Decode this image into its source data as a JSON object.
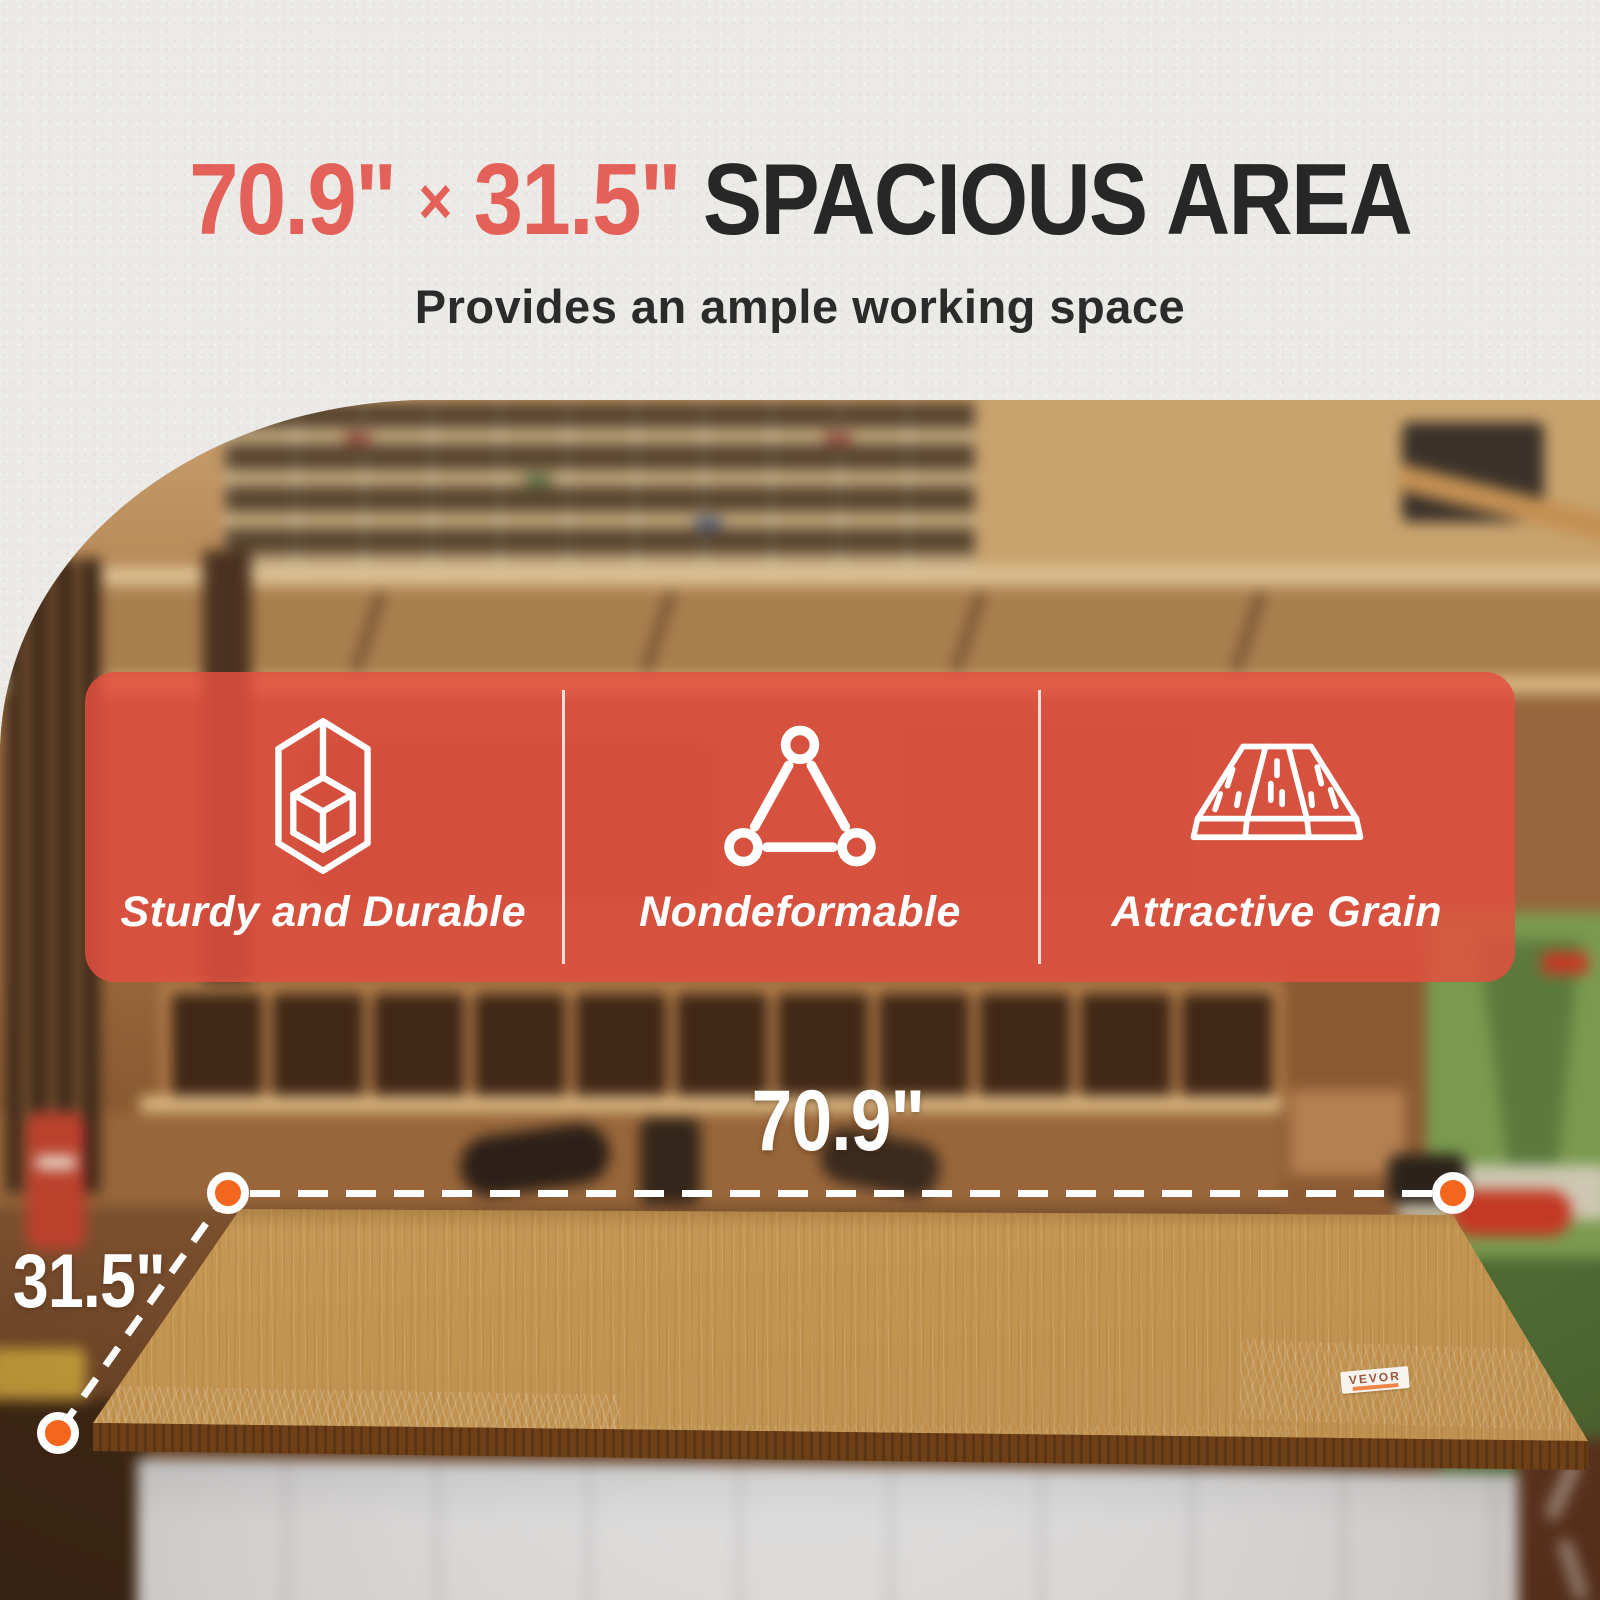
{
  "header": {
    "width_value": "70.9\"",
    "times_sign": "×",
    "depth_value": "31.5\"",
    "title_text": "SPACIOUS AREA",
    "subtitle": "Provides an ample working space"
  },
  "features": [
    {
      "icon": "cube-wireframe-icon",
      "label": "Sturdy and Durable"
    },
    {
      "icon": "triangle-nodes-icon",
      "label": "Nondeformable"
    },
    {
      "icon": "wood-grain-icon",
      "label": "Attractive Grain"
    }
  ],
  "dimension_callouts": {
    "width_label": "70.9\"",
    "depth_label": "31.5\""
  },
  "product": {
    "brand_label": "VEVOR"
  },
  "colors": {
    "accent_red": "#E4615A",
    "heading_dark": "#272727",
    "banner_overlay": "#E34F3F",
    "marker_orange": "#F4661E",
    "wood_light": "#D2AC74",
    "wood_edge": "#7C4A1E"
  }
}
